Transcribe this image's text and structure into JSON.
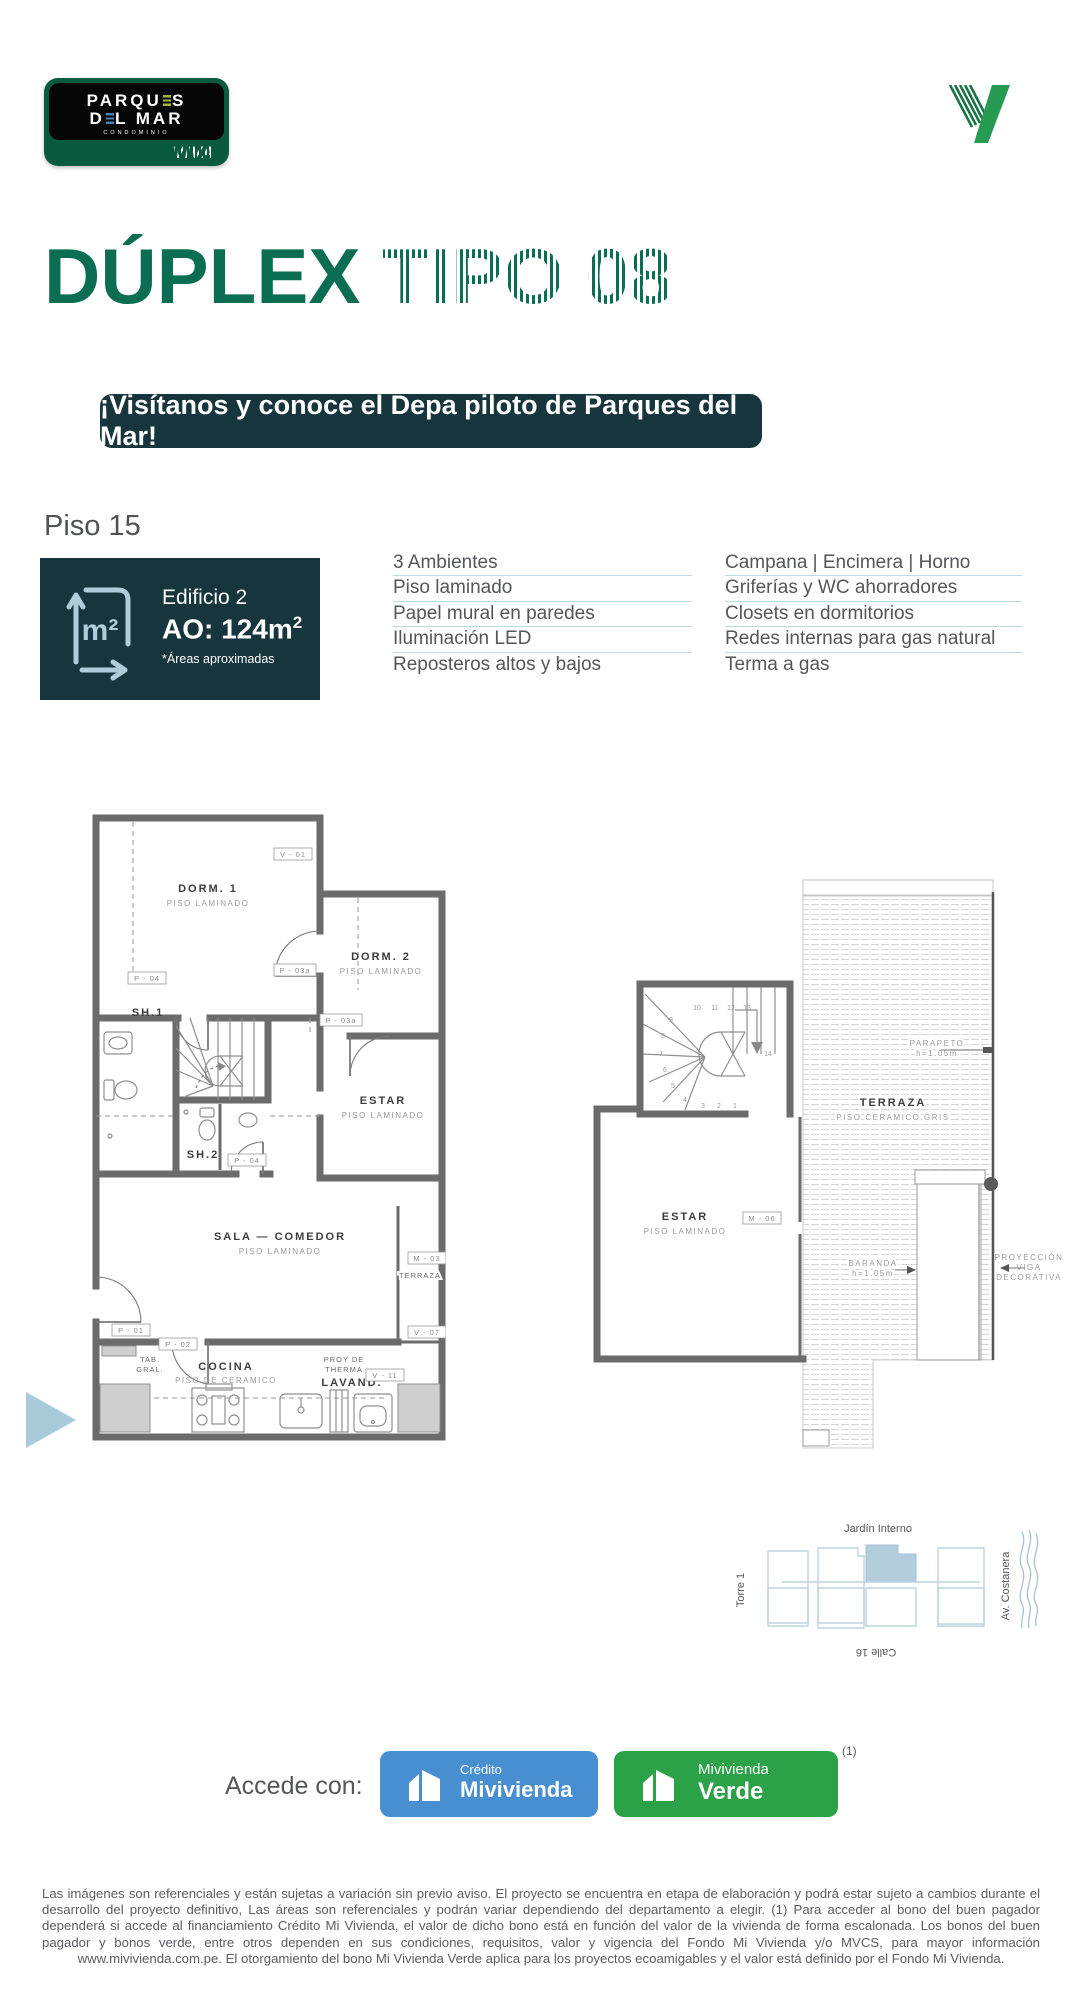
{
  "logo": {
    "l1a": "PARQU",
    "l1b": "S",
    "l2a": "D",
    "l2b": "L MAR",
    "sub": "CONDOMINIO",
    "brand": "VIVA"
  },
  "title": {
    "solid": "DÚPLEX",
    "striped": "TIPO 08"
  },
  "banner": {
    "text": "¡Visítanos y conoce el Depa piloto de Parques del Mar!"
  },
  "floor": {
    "label": "Piso 15"
  },
  "info_box": {
    "building": "Edificio 2",
    "area": "AO: 124m",
    "area_sup": "2",
    "note": "*Áreas aproximadas",
    "icon": "m2-area-icon"
  },
  "features": {
    "left": [
      "3 Ambientes",
      "Piso laminado",
      "Papel mural en paredes",
      "Iluminación LED",
      "Reposteros altos y bajos"
    ],
    "right": [
      "Campana | Encimera | Horno",
      "Griferías y WC ahorradores",
      "Closets en dormitorios",
      "Redes internas para gas natural",
      "Terma a gas"
    ]
  },
  "plan1": {
    "dorm1": "DORM.  1",
    "dorm1_sub": "PISO  LAMINADO",
    "dorm2": "DORM.  2",
    "dorm2_sub": "PISO  LAMINADO",
    "sh1": "SH.1",
    "sh2": "SH.2",
    "estar": "ESTAR",
    "estar_sub": "PISO  LAMINADO",
    "sala": "SALA  —  COMEDOR",
    "sala_sub": "PISO  LAMINADO",
    "cocina": "COCINA",
    "cocina_sub": "PISO  DE  CERAMICO",
    "lavand": "LAVAND.",
    "proy_a": "PROY  DE",
    "proy_b": "THERMA",
    "tab_a": "TAB.",
    "tab_b": "GRAL.",
    "terraza": "TERRAZA",
    "tags": {
      "v01": "V - 01",
      "p03a": "P - 03a",
      "p03b": "P - 03a",
      "p04a": "P - 04",
      "p04b": "P - 04",
      "m03": "M - 03",
      "p01": "P - 01",
      "p02": "P - 02",
      "v07": "V - 07",
      "v11": "V - 11"
    }
  },
  "plan2": {
    "estar": "ESTAR",
    "estar_sub": "PISO  LAMINADO",
    "terraza": "TERRAZA",
    "terraza_sub": "PISO  CERAMICO  GRIS",
    "parapeto_a": "PARAPETO",
    "parapeto_b": "h=1.05m",
    "baranda_a": "BARANDA",
    "baranda_b": "h=1.05m",
    "m06": "M - 06",
    "proy_a": "PROYECCIÓN",
    "proy_b": "VIGA",
    "proy_c": "DECORATIVA",
    "steps": [
      "1",
      "2",
      "3",
      "4",
      "5",
      "6",
      "7",
      "8",
      "9",
      "10",
      "11",
      "12",
      "13",
      "14"
    ]
  },
  "site_map": {
    "top": "Jardín Interno",
    "left": "Torre 1",
    "right": "Av. Costanera",
    "bottom": "Calle 16"
  },
  "access": {
    "label": "Accede con:",
    "credito_top": "Crédito",
    "credito_bottom": "Mivivienda",
    "verde_top": "Mivivienda",
    "verde_bottom": "Verde",
    "footnote": "(1)"
  },
  "disclaimer": "Las imágenes son referenciales y están sujetas a variación sin previo aviso. El proyecto se encuentra en etapa de elaboración y podrá estar sujeto a cambios durante el desarrollo del proyecto definitivo, Las áreas son referenciales y podrán variar dependiendo del departamento a elegir. (1) Para acceder al bono del buen pagador dependerá si accede al financiamiento Crédito Mi Vivienda, el valor de dicho bono está en función del valor de la vivienda de forma escalonada. Los bonos del buen pagador y bonos verde, entre otros dependen en sus condiciones, requisitos, valor y vigencia del Fondo Mi Vivienda y/o MVCS, para mayor información www.mivivienda.com.pe. El otorgamiento del bono Mi Vivienda Verde aplica para los proyectos ecoamigables y el valor está definido por el Fondo Mi Vivienda.",
  "colors": {
    "brand_green": "#0B6E52",
    "teal_dark": "#17353C",
    "light_blue": "#AECCD9",
    "line_blue": "#BCD8E4",
    "text_gray": "#55565A",
    "btn_blue": "#478FD1",
    "btn_green": "#2BA148"
  }
}
